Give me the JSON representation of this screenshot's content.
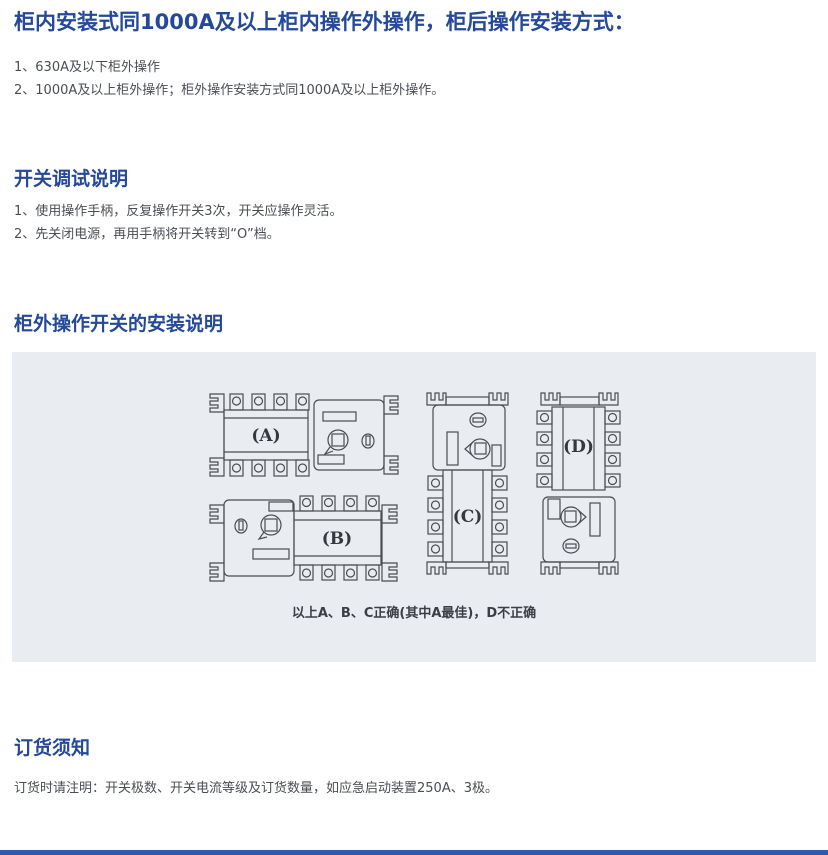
{
  "intro": {
    "title": "柜内安装式同1000A及以上柜内操作外操作，柜后操作安装方式：",
    "items": [
      "1、630A及以下柜外操作",
      "2、1000A及以上柜外操作；柜外操作安装方式同1000A及以上柜外操作。"
    ]
  },
  "debug_section": {
    "title": "开关调试说明",
    "items": [
      "1、使用操作手柄，反复操作开关3次，开关应操作灵活。",
      "2、先关闭电源，再用手柄将开关转到“O”档。"
    ]
  },
  "install_section": {
    "title": "柜外操作开关的安装说明",
    "diagram_labels": {
      "a": "(A)",
      "b": "(B)",
      "c": "(C)",
      "d": "(D)"
    },
    "caption": "以上A、B、C正确(其中A最佳)，D不正确"
  },
  "order_section": {
    "title": "订货须知",
    "note": "订货时请注明：开关极数、开关电流等级及订货数量，如应急启动装置250A、3极。"
  },
  "colors": {
    "heading_blue": "#25499a",
    "body_text": "#4a4d54",
    "panel_bg": "#e9edf2",
    "diagram_line": "#4b4d52",
    "footer_blue": "#2e5ba8"
  }
}
